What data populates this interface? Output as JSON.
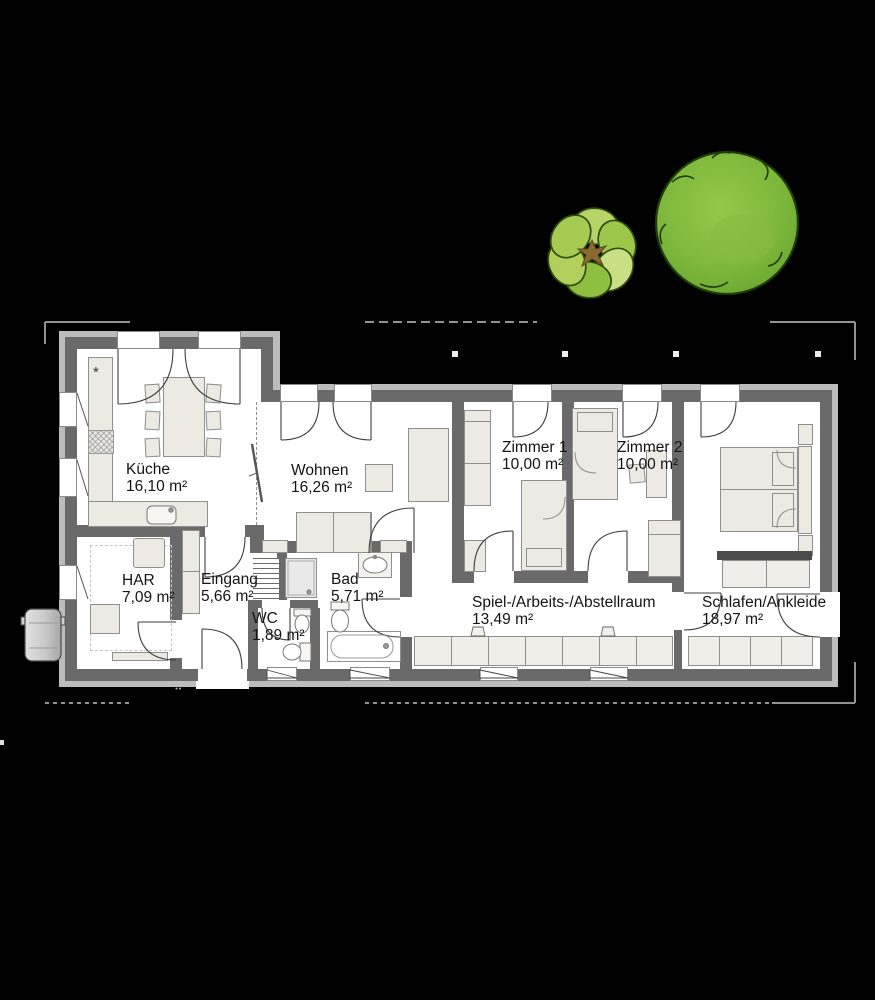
{
  "plan": {
    "background": "#000000",
    "colors": {
      "wall": "#6a6a6a",
      "outer_band": "#bcbcbc",
      "floor": "#ffffff",
      "furniture_fill": "#eceae3",
      "furniture_line": "#8f8f8f",
      "dresser_top": "#4b4b4b",
      "boundary_line": "#929292",
      "tree_green": "#7fb93c",
      "tree_outline": "#1f3b0d",
      "tree_small_light": "#c9df85"
    },
    "rooms": [
      {
        "id": "kueche",
        "name": "Küche",
        "area": "16,10 m²"
      },
      {
        "id": "wohnen",
        "name": "Wohnen",
        "area": "16,26 m²"
      },
      {
        "id": "zimmer1",
        "name": "Zimmer 1",
        "area": "10,00 m²"
      },
      {
        "id": "zimmer2",
        "name": "Zimmer 2",
        "area": "10,00 m²"
      },
      {
        "id": "har",
        "name": "HAR",
        "area": "7,09 m²"
      },
      {
        "id": "eingang",
        "name": "Eingang",
        "area": "5,66 m²"
      },
      {
        "id": "wc",
        "name": "WC",
        "area": "1,89 m²"
      },
      {
        "id": "bad",
        "name": "Bad",
        "area": "5,71 m²"
      },
      {
        "id": "spielraum",
        "name": "Spiel-/Arbeits-/Abstellraum",
        "area": "13,49 m²"
      },
      {
        "id": "schlafen",
        "name": "Schlafen/Ankleide",
        "area": "18,97 m²"
      }
    ],
    "symbols": {
      "kitchen_star": "*"
    }
  }
}
